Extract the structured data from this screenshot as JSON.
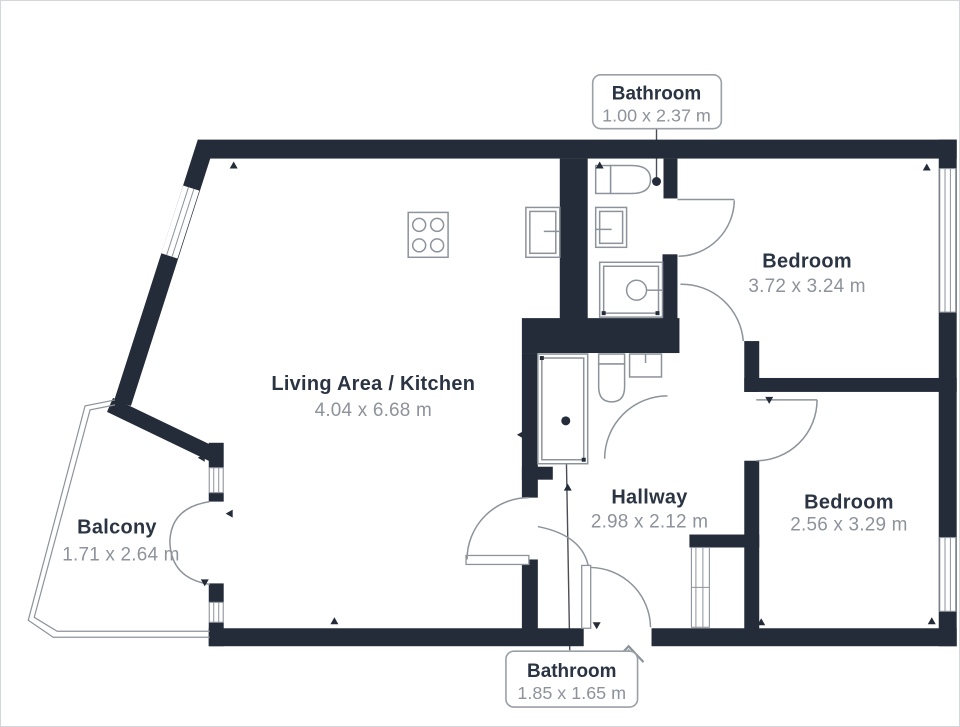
{
  "rooms": {
    "living": {
      "name": "Living Area / Kitchen",
      "dims": "4.04 x 6.68 m"
    },
    "balcony": {
      "name": "Balcony",
      "dims": "1.71 x 2.64 m"
    },
    "bedroom_top": {
      "name": "Bedroom",
      "dims": "3.72 x 3.24 m"
    },
    "bedroom_bottom": {
      "name": "Bedroom",
      "dims": "2.56 x 3.29 m"
    },
    "hallway": {
      "name": "Hallway",
      "dims": "2.98 x 2.12 m"
    }
  },
  "callouts": {
    "bathroom_top": {
      "name": "Bathroom",
      "dims": "1.00 x 2.37 m"
    },
    "bathroom_bottom": {
      "name": "Bathroom",
      "dims": "1.85 x 1.65 m"
    }
  },
  "colors": {
    "wall": "#242c3a",
    "fixture_line": "#8d939b",
    "room_name": "#2b3442",
    "room_dims": "#8d929b",
    "background": "#ffffff",
    "callout_border": "#9aa0a6",
    "leader": "#4a4f57"
  },
  "icons": {
    "stove": "stove-icon",
    "kitchen_sink": "sink-icon",
    "toilet": "toilet-icon",
    "shower": "shower-icon",
    "door": "door-swing-arc-icon",
    "window": "window-band-icon",
    "entry": "entry-arrow-icon",
    "cupboard": "cupboard-icon"
  }
}
